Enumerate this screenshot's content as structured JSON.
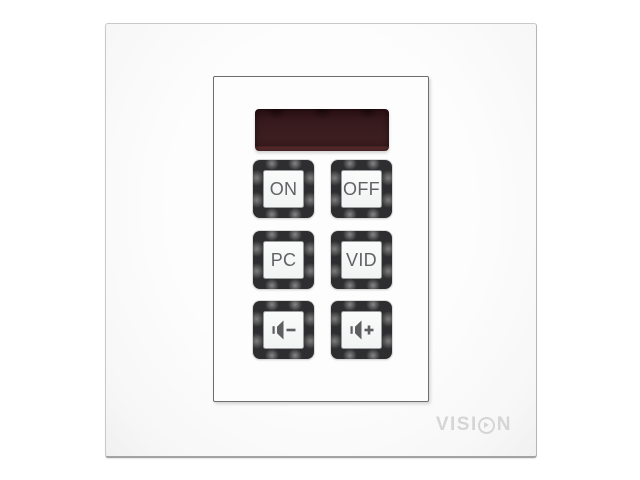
{
  "device": {
    "kind": "wall-mounted av control keypad"
  },
  "display": {
    "text": ""
  },
  "buttons": [
    {
      "id": "on",
      "label": "ON",
      "icon": null
    },
    {
      "id": "off",
      "label": "OFF",
      "icon": null
    },
    {
      "id": "pc",
      "label": "PC",
      "icon": null
    },
    {
      "id": "vid",
      "label": "VID",
      "icon": null
    },
    {
      "id": "volume-down",
      "label": "",
      "icon": "volume-down-icon"
    },
    {
      "id": "volume-up",
      "label": "",
      "icon": "volume-up-icon"
    }
  ],
  "brand": {
    "text": "VISION",
    "prefix": "VISI",
    "suffix": "N"
  },
  "colors": {
    "display_body": "#381a1d",
    "display_glow_strip": "#5a2c2d",
    "button_frame": "#2e2e30",
    "button_cap": "#f7f8f8",
    "button_label": "#606265",
    "icon_gray": "#5c5e60",
    "brand_gray": "#d5d5d5",
    "plate_white": "#fbfbfb"
  }
}
